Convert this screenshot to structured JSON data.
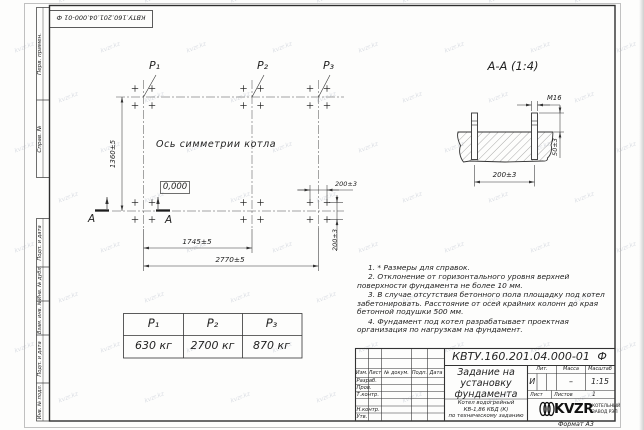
{
  "watermark": "kvzr.kz",
  "top_stamp": "КВТУ.160.201.04.000-01 Ф",
  "side_strip": {
    "perv": "Перв. примен.",
    "sprav": "Справ. №",
    "podp1": "Подп. и дата",
    "inv_dubl": "Инв. № дубл.",
    "vzam": "Взам. инв. №",
    "podp2": "Подп. и дата",
    "inv_podl": "Инв. № подл."
  },
  "plan": {
    "points": [
      "P₁",
      "P₂",
      "P₃"
    ],
    "axis_label": "Ось симметрии котла",
    "elevation": "0,000",
    "dim_height": "1360±5",
    "dim_p1p2": "1745±5",
    "dim_total": "2770±5",
    "dim_bolt_x": "200±3",
    "dim_bolt_y": "200±3",
    "section_letter": "А"
  },
  "section": {
    "title": "А-А (1:4)",
    "thread": "М16",
    "dim_protrusion": "50±3",
    "dim_spacing": "200±3"
  },
  "load_table": {
    "headers": [
      "P₁",
      "P₂",
      "P₃"
    ],
    "values": [
      "630 кг",
      "2700 кг",
      "870 кг"
    ]
  },
  "notes": [
    "1. * Размеры для справок.",
    "2. Отклонение от горизонтального уровня верхней поверхности фундамента не более 10 мм.",
    "3. В случае отсутствия бетонного пола площадку под котел забетонировать. Расстояние от осей крайних колонн до края бетонной подушки 500 мм.",
    "4. Фундамент под котел разрабатывает проектная организация по нагрузкам на фундамент."
  ],
  "title_block": {
    "doc_number": "КВТУ.160.201.04.000-01 Ф",
    "title_line1": "Задание на",
    "title_line2": "установку",
    "title_line3": "фундамента",
    "product_line1": "Котел водогрейный",
    "product_line2": "КВ-1,86 КБД (К)",
    "product_line3": "по техническому заданию",
    "cols": [
      "Изм.",
      "Лист",
      "№ докум.",
      "Подп.",
      "Дата"
    ],
    "rows": [
      "Разраб.",
      "Пров.",
      "Т.контр.",
      "Н.контр.",
      "Утв."
    ],
    "lit_label": "Лит.",
    "lit_value": "И",
    "mass_label": "Масса",
    "mass_value": "–",
    "scale_label": "Масштаб",
    "scale_value": "1:15",
    "sheet_label": "Лист",
    "sheets_label": "Листов",
    "sheets_value": "1",
    "logo": "KVZR",
    "logo_caption1": "КОТЕЛЬНЫЙ",
    "logo_caption2": "ЗАВОД РЭП",
    "format_label": "Формат А3"
  }
}
